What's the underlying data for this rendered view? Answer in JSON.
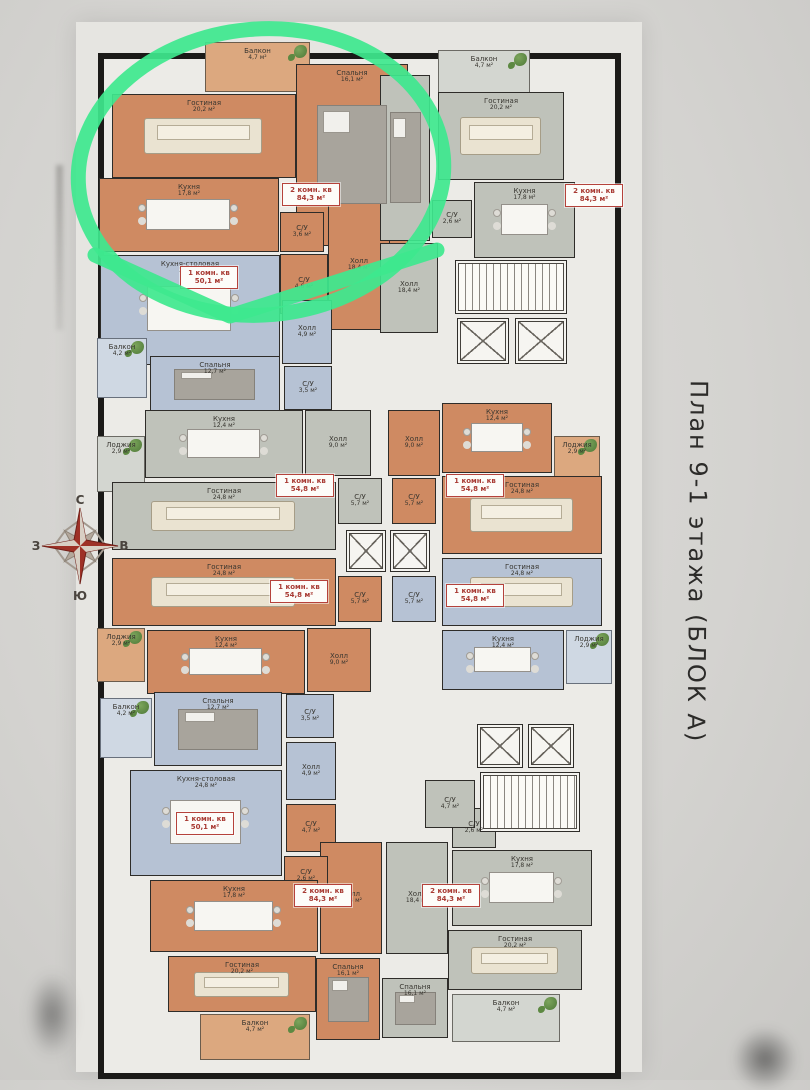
{
  "title": {
    "text": "План 9-1  этажа  (БЛОК А)"
  },
  "compass": {
    "north": "С",
    "south": "Ю",
    "west": "З",
    "east": "В",
    "star_color": "#9e3127"
  },
  "marker": {
    "color": "#3ee88e"
  },
  "plan": {
    "wall_color": "#1b1a18",
    "palette": {
      "orange": "#cf8a62",
      "orange_light": "#dca87f",
      "gray": "#bfc2ba",
      "gray_light": "#d3d6d0",
      "blue": "#b6c2d4",
      "blue_light": "#cfd8e3",
      "core": "#f4f3ef",
      "base": "#ecebe7",
      "tag_red": "#a83a33",
      "marker_green": "#3ee88e"
    },
    "rooms": [
      {
        "id": "balcony-a1",
        "label": "Балкон",
        "area": "4,7 м²",
        "color": "ol",
        "x": 110,
        "y": 4,
        "w": 105,
        "h": 50,
        "furn": "plant"
      },
      {
        "id": "bedroom-a1",
        "label": "Спальня",
        "area": "16,1 м²",
        "color": "o",
        "x": 201,
        "y": 26,
        "w": 112,
        "h": 182,
        "furn": "bed"
      },
      {
        "id": "living-a1",
        "label": "Гостиная",
        "area": "20,2 м²",
        "color": "o",
        "x": 17,
        "y": 56,
        "w": 184,
        "h": 84,
        "furn": "sofa"
      },
      {
        "id": "kitchen-a1",
        "label": "Кухня",
        "area": "17,8 м²",
        "color": "o",
        "x": 4,
        "y": 140,
        "w": 180,
        "h": 74,
        "furn": "table"
      },
      {
        "id": "wc1-a1",
        "label": "С/У",
        "area": "3,6 м²",
        "color": "o",
        "x": 185,
        "y": 174,
        "w": 44,
        "h": 40
      },
      {
        "id": "hall-a1",
        "label": "Холл",
        "area": "18,4 м²",
        "color": "o",
        "x": 233,
        "y": 162,
        "w": 62,
        "h": 130
      },
      {
        "id": "wc2-a1",
        "label": "С/У",
        "area": "4,6 м²",
        "color": "o",
        "x": 185,
        "y": 216,
        "w": 48,
        "h": 60
      },
      {
        "id": "balcony-a2",
        "label": "Балкон",
        "area": "4,7 м²",
        "color": "gl",
        "x": 343,
        "y": 12,
        "w": 92,
        "h": 48,
        "furn": "plant"
      },
      {
        "id": "bedroom-a2",
        "label": "",
        "area": "",
        "color": "g",
        "x": 285,
        "y": 37,
        "w": 50,
        "h": 166,
        "furn": "bed"
      },
      {
        "id": "living-a2",
        "label": "Гостиная",
        "area": "20,2 м²",
        "color": "g",
        "x": 343,
        "y": 54,
        "w": 126,
        "h": 88,
        "furn": "sofa"
      },
      {
        "id": "kitchen-a2",
        "label": "Кухня",
        "area": "17,8 м²",
        "color": "g",
        "x": 379,
        "y": 144,
        "w": 101,
        "h": 76,
        "furn": "table"
      },
      {
        "id": "wc-a2",
        "label": "С/У",
        "area": "2,6 м²",
        "color": "g",
        "x": 337,
        "y": 162,
        "w": 40,
        "h": 38
      },
      {
        "id": "hall-a2",
        "label": "Холл",
        "area": "18,4 м²",
        "color": "g",
        "x": 285,
        "y": 205,
        "w": 58,
        "h": 90
      },
      {
        "id": "stairs-1",
        "label": "",
        "area": "",
        "color": "w",
        "x": 360,
        "y": 222,
        "w": 112,
        "h": 54,
        "furn": "stairs"
      },
      {
        "id": "elevator-1",
        "label": "",
        "area": "",
        "color": "w",
        "x": 362,
        "y": 280,
        "w": 52,
        "h": 46,
        "furn": "elev"
      },
      {
        "id": "elevator-2",
        "label": "",
        "area": "",
        "color": "w",
        "x": 420,
        "y": 280,
        "w": 52,
        "h": 46,
        "furn": "elev"
      },
      {
        "id": "dining-b1",
        "label": "Кухня-столовая",
        "area": "24,8 м²",
        "color": "b",
        "x": 5,
        "y": 217,
        "w": 180,
        "h": 110,
        "furn": "table"
      },
      {
        "id": "hall-b1",
        "label": "Холл",
        "area": "4,9 м²",
        "color": "b",
        "x": 187,
        "y": 262,
        "w": 50,
        "h": 64
      },
      {
        "id": "bedroom-b1",
        "label": "Спальня",
        "area": "12,7 м²",
        "color": "b",
        "x": 55,
        "y": 318,
        "w": 130,
        "h": 56,
        "furn": "bed"
      },
      {
        "id": "wc-b1",
        "label": "С/У",
        "area": "3,5 м²",
        "color": "b",
        "x": 189,
        "y": 328,
        "w": 48,
        "h": 44
      },
      {
        "id": "balcony-b1",
        "label": "Балкон",
        "area": "4,2 м²",
        "color": "bl2",
        "x": 2,
        "y": 300,
        "w": 50,
        "h": 60,
        "furn": "plant"
      },
      {
        "id": "lodzhia-c1",
        "label": "Лоджия",
        "area": "2,9 м²",
        "color": "gl",
        "x": 2,
        "y": 398,
        "w": 48,
        "h": 56,
        "furn": "plant"
      },
      {
        "id": "kitchen-c1",
        "label": "Кухня",
        "area": "12,4 м²",
        "color": "g",
        "x": 50,
        "y": 372,
        "w": 158,
        "h": 68,
        "furn": "table"
      },
      {
        "id": "hall-c1",
        "label": "Холл",
        "area": "9,0 м²",
        "color": "g",
        "x": 210,
        "y": 372,
        "w": 66,
        "h": 66
      },
      {
        "id": "living-c1",
        "label": "Гостиная",
        "area": "24,8 м²",
        "color": "g",
        "x": 17,
        "y": 444,
        "w": 224,
        "h": 68,
        "furn": "sofa"
      },
      {
        "id": "wc-c1",
        "label": "С/У",
        "area": "5,7 м²",
        "color": "g",
        "x": 243,
        "y": 440,
        "w": 44,
        "h": 46
      },
      {
        "id": "hall-c2",
        "label": "Холл",
        "area": "9,0 м²",
        "color": "o",
        "x": 293,
        "y": 372,
        "w": 52,
        "h": 66
      },
      {
        "id": "kitchen-c2",
        "label": "Кухня",
        "area": "12,4 м²",
        "color": "o",
        "x": 347,
        "y": 365,
        "w": 110,
        "h": 70,
        "furn": "table"
      },
      {
        "id": "lodzhia-c2",
        "label": "Лоджия",
        "area": "2,9 м²",
        "color": "ol",
        "x": 459,
        "y": 398,
        "w": 46,
        "h": 54,
        "furn": "plant"
      },
      {
        "id": "living-c2",
        "label": "Гостиная",
        "area": "24,8 м²",
        "color": "o",
        "x": 347,
        "y": 438,
        "w": 160,
        "h": 78,
        "furn": "sofa"
      },
      {
        "id": "wc-c2",
        "label": "С/У",
        "area": "5,7 м²",
        "color": "o",
        "x": 297,
        "y": 440,
        "w": 44,
        "h": 46
      },
      {
        "id": "elevator-3",
        "label": "",
        "area": "",
        "color": "w",
        "x": 251,
        "y": 492,
        "w": 40,
        "h": 42,
        "furn": "elev"
      },
      {
        "id": "elevator-4",
        "label": "",
        "area": "",
        "color": "w",
        "x": 295,
        "y": 492,
        "w": 40,
        "h": 42,
        "furn": "elev"
      },
      {
        "id": "living-c3",
        "label": "Гостиная",
        "area": "24,8 м²",
        "color": "o",
        "x": 17,
        "y": 520,
        "w": 224,
        "h": 68,
        "furn": "sofa"
      },
      {
        "id": "wc-c3",
        "label": "С/У",
        "area": "5,7 м²",
        "color": "o",
        "x": 243,
        "y": 538,
        "w": 44,
        "h": 46
      },
      {
        "id": "lodzhia-c3",
        "label": "Лоджия",
        "area": "2,9 м²",
        "color": "ol",
        "x": 2,
        "y": 590,
        "w": 48,
        "h": 54,
        "furn": "plant"
      },
      {
        "id": "kitchen-c3",
        "label": "Кухня",
        "area": "12,4 м²",
        "color": "o",
        "x": 52,
        "y": 592,
        "w": 158,
        "h": 64,
        "furn": "table"
      },
      {
        "id": "hall-c3",
        "label": "Холл",
        "area": "9,0 м²",
        "color": "o",
        "x": 212,
        "y": 590,
        "w": 64,
        "h": 64
      },
      {
        "id": "living-c4",
        "label": "Гостиная",
        "area": "24,8 м²",
        "color": "b",
        "x": 347,
        "y": 520,
        "w": 160,
        "h": 68,
        "furn": "sofa"
      },
      {
        "id": "wc-c4",
        "label": "С/У",
        "area": "5,7 м²",
        "color": "b",
        "x": 297,
        "y": 538,
        "w": 44,
        "h": 46
      },
      {
        "id": "kitchen-c4",
        "label": "Кухня",
        "area": "12,4 м²",
        "color": "b",
        "x": 347,
        "y": 592,
        "w": 122,
        "h": 60,
        "furn": "table"
      },
      {
        "id": "lodzhia-c4",
        "label": "Лоджия",
        "area": "2,9 м²",
        "color": "bl2",
        "x": 471,
        "y": 592,
        "w": 46,
        "h": 54,
        "furn": "plant"
      },
      {
        "id": "balcony-d1",
        "label": "Балкон",
        "area": "4,2 м²",
        "color": "bl2",
        "x": 5,
        "y": 660,
        "w": 52,
        "h": 60,
        "furn": "plant"
      },
      {
        "id": "bedroom-d1",
        "label": "Спальня",
        "area": "12,7 м²",
        "color": "b",
        "x": 59,
        "y": 654,
        "w": 128,
        "h": 74,
        "furn": "bed"
      },
      {
        "id": "wc-d1",
        "label": "С/У",
        "area": "3,5 м²",
        "color": "b",
        "x": 191,
        "y": 656,
        "w": 48,
        "h": 44
      },
      {
        "id": "hall-d1",
        "label": "Холл",
        "area": "4,9 м²",
        "color": "b",
        "x": 191,
        "y": 704,
        "w": 50,
        "h": 58
      },
      {
        "id": "dining-d1",
        "label": "Кухня-столовая",
        "area": "24,8 м²",
        "color": "b",
        "x": 35,
        "y": 732,
        "w": 152,
        "h": 106,
        "furn": "table"
      },
      {
        "id": "wc-d2",
        "label": "С/У",
        "area": "4,7 м²",
        "color": "o",
        "x": 191,
        "y": 766,
        "w": 50,
        "h": 48
      },
      {
        "id": "hall-d2",
        "label": "Холл",
        "area": "18,4 м²",
        "color": "o",
        "x": 225,
        "y": 804,
        "w": 62,
        "h": 112
      },
      {
        "id": "wc2-d2",
        "label": "С/У",
        "area": "2,6 м²",
        "color": "o",
        "x": 189,
        "y": 818,
        "w": 44,
        "h": 40
      },
      {
        "id": "kitchen-d2",
        "label": "Кухня",
        "area": "17,8 м²",
        "color": "o",
        "x": 55,
        "y": 842,
        "w": 168,
        "h": 72,
        "furn": "table"
      },
      {
        "id": "living-d2",
        "label": "Гостиная",
        "area": "20,2 м²",
        "color": "o",
        "x": 73,
        "y": 918,
        "w": 148,
        "h": 56,
        "furn": "sofa"
      },
      {
        "id": "bedroom-d2",
        "label": "Спальня",
        "area": "16,1 м²",
        "color": "o",
        "x": 221,
        "y": 920,
        "w": 64,
        "h": 82,
        "furn": "bed"
      },
      {
        "id": "balcony-d2",
        "label": "Балкон",
        "area": "4,7 м²",
        "color": "ol",
        "x": 105,
        "y": 976,
        "w": 110,
        "h": 46,
        "furn": "plant"
      },
      {
        "id": "hall-d3",
        "label": "Холл",
        "area": "18,4 м²",
        "color": "g",
        "x": 291,
        "y": 804,
        "w": 62,
        "h": 112
      },
      {
        "id": "wc-d3",
        "label": "С/У",
        "area": "2,6 м²",
        "color": "g",
        "x": 357,
        "y": 770,
        "w": 44,
        "h": 40
      },
      {
        "id": "kitchen-d3",
        "label": "Кухня",
        "area": "17,8 м²",
        "color": "g",
        "x": 357,
        "y": 812,
        "w": 140,
        "h": 76,
        "furn": "table"
      },
      {
        "id": "living-d3",
        "label": "Гостиная",
        "area": "20,2 м²",
        "color": "g",
        "x": 353,
        "y": 892,
        "w": 134,
        "h": 60,
        "furn": "sofa"
      },
      {
        "id": "bedroom-d3",
        "label": "Спальня",
        "area": "16,1 м²",
        "color": "g",
        "x": 287,
        "y": 940,
        "w": 66,
        "h": 60,
        "furn": "bed"
      },
      {
        "id": "balcony-d3",
        "label": "Балкон",
        "area": "4,7 м²",
        "color": "gl",
        "x": 357,
        "y": 956,
        "w": 108,
        "h": 48,
        "furn": "plant"
      },
      {
        "id": "elevator-5",
        "label": "",
        "area": "",
        "color": "w",
        "x": 382,
        "y": 686,
        "w": 46,
        "h": 44,
        "furn": "elev"
      },
      {
        "id": "elevator-6",
        "label": "",
        "area": "",
        "color": "w",
        "x": 433,
        "y": 686,
        "w": 46,
        "h": 44,
        "furn": "elev"
      },
      {
        "id": "stairs-2",
        "label": "",
        "area": "",
        "color": "w",
        "x": 385,
        "y": 734,
        "w": 100,
        "h": 60,
        "furn": "stairs"
      },
      {
        "id": "wc-d4",
        "label": "С/У",
        "area": "4,7 м²",
        "color": "g",
        "x": 330,
        "y": 742,
        "w": 50,
        "h": 48
      }
    ],
    "tags": [
      {
        "type": "2 комн. кв",
        "area": "84,3 м²",
        "x": 187,
        "y": 145
      },
      {
        "type": "2 комн. кв",
        "area": "84,3 м²",
        "x": 470,
        "y": 146
      },
      {
        "type": "1 комн. кв",
        "area": "50,1 м²",
        "x": 85,
        "y": 228
      },
      {
        "type": "1 комн. кв",
        "area": "54,8 м²",
        "x": 181,
        "y": 436
      },
      {
        "type": "1 комн. кв",
        "area": "54,8 м²",
        "x": 351,
        "y": 436
      },
      {
        "type": "1 комн. кв",
        "area": "54,8 м²",
        "x": 175,
        "y": 542
      },
      {
        "type": "1 комн. кв",
        "area": "54,8 м²",
        "x": 351,
        "y": 546
      },
      {
        "type": "1 комн. кв",
        "area": "50,1 м²",
        "x": 81,
        "y": 774
      },
      {
        "type": "2 комн. кв",
        "area": "84,3 м²",
        "x": 199,
        "y": 846
      },
      {
        "type": "2 комн. кв",
        "area": "84,3 м²",
        "x": 327,
        "y": 846
      }
    ]
  }
}
